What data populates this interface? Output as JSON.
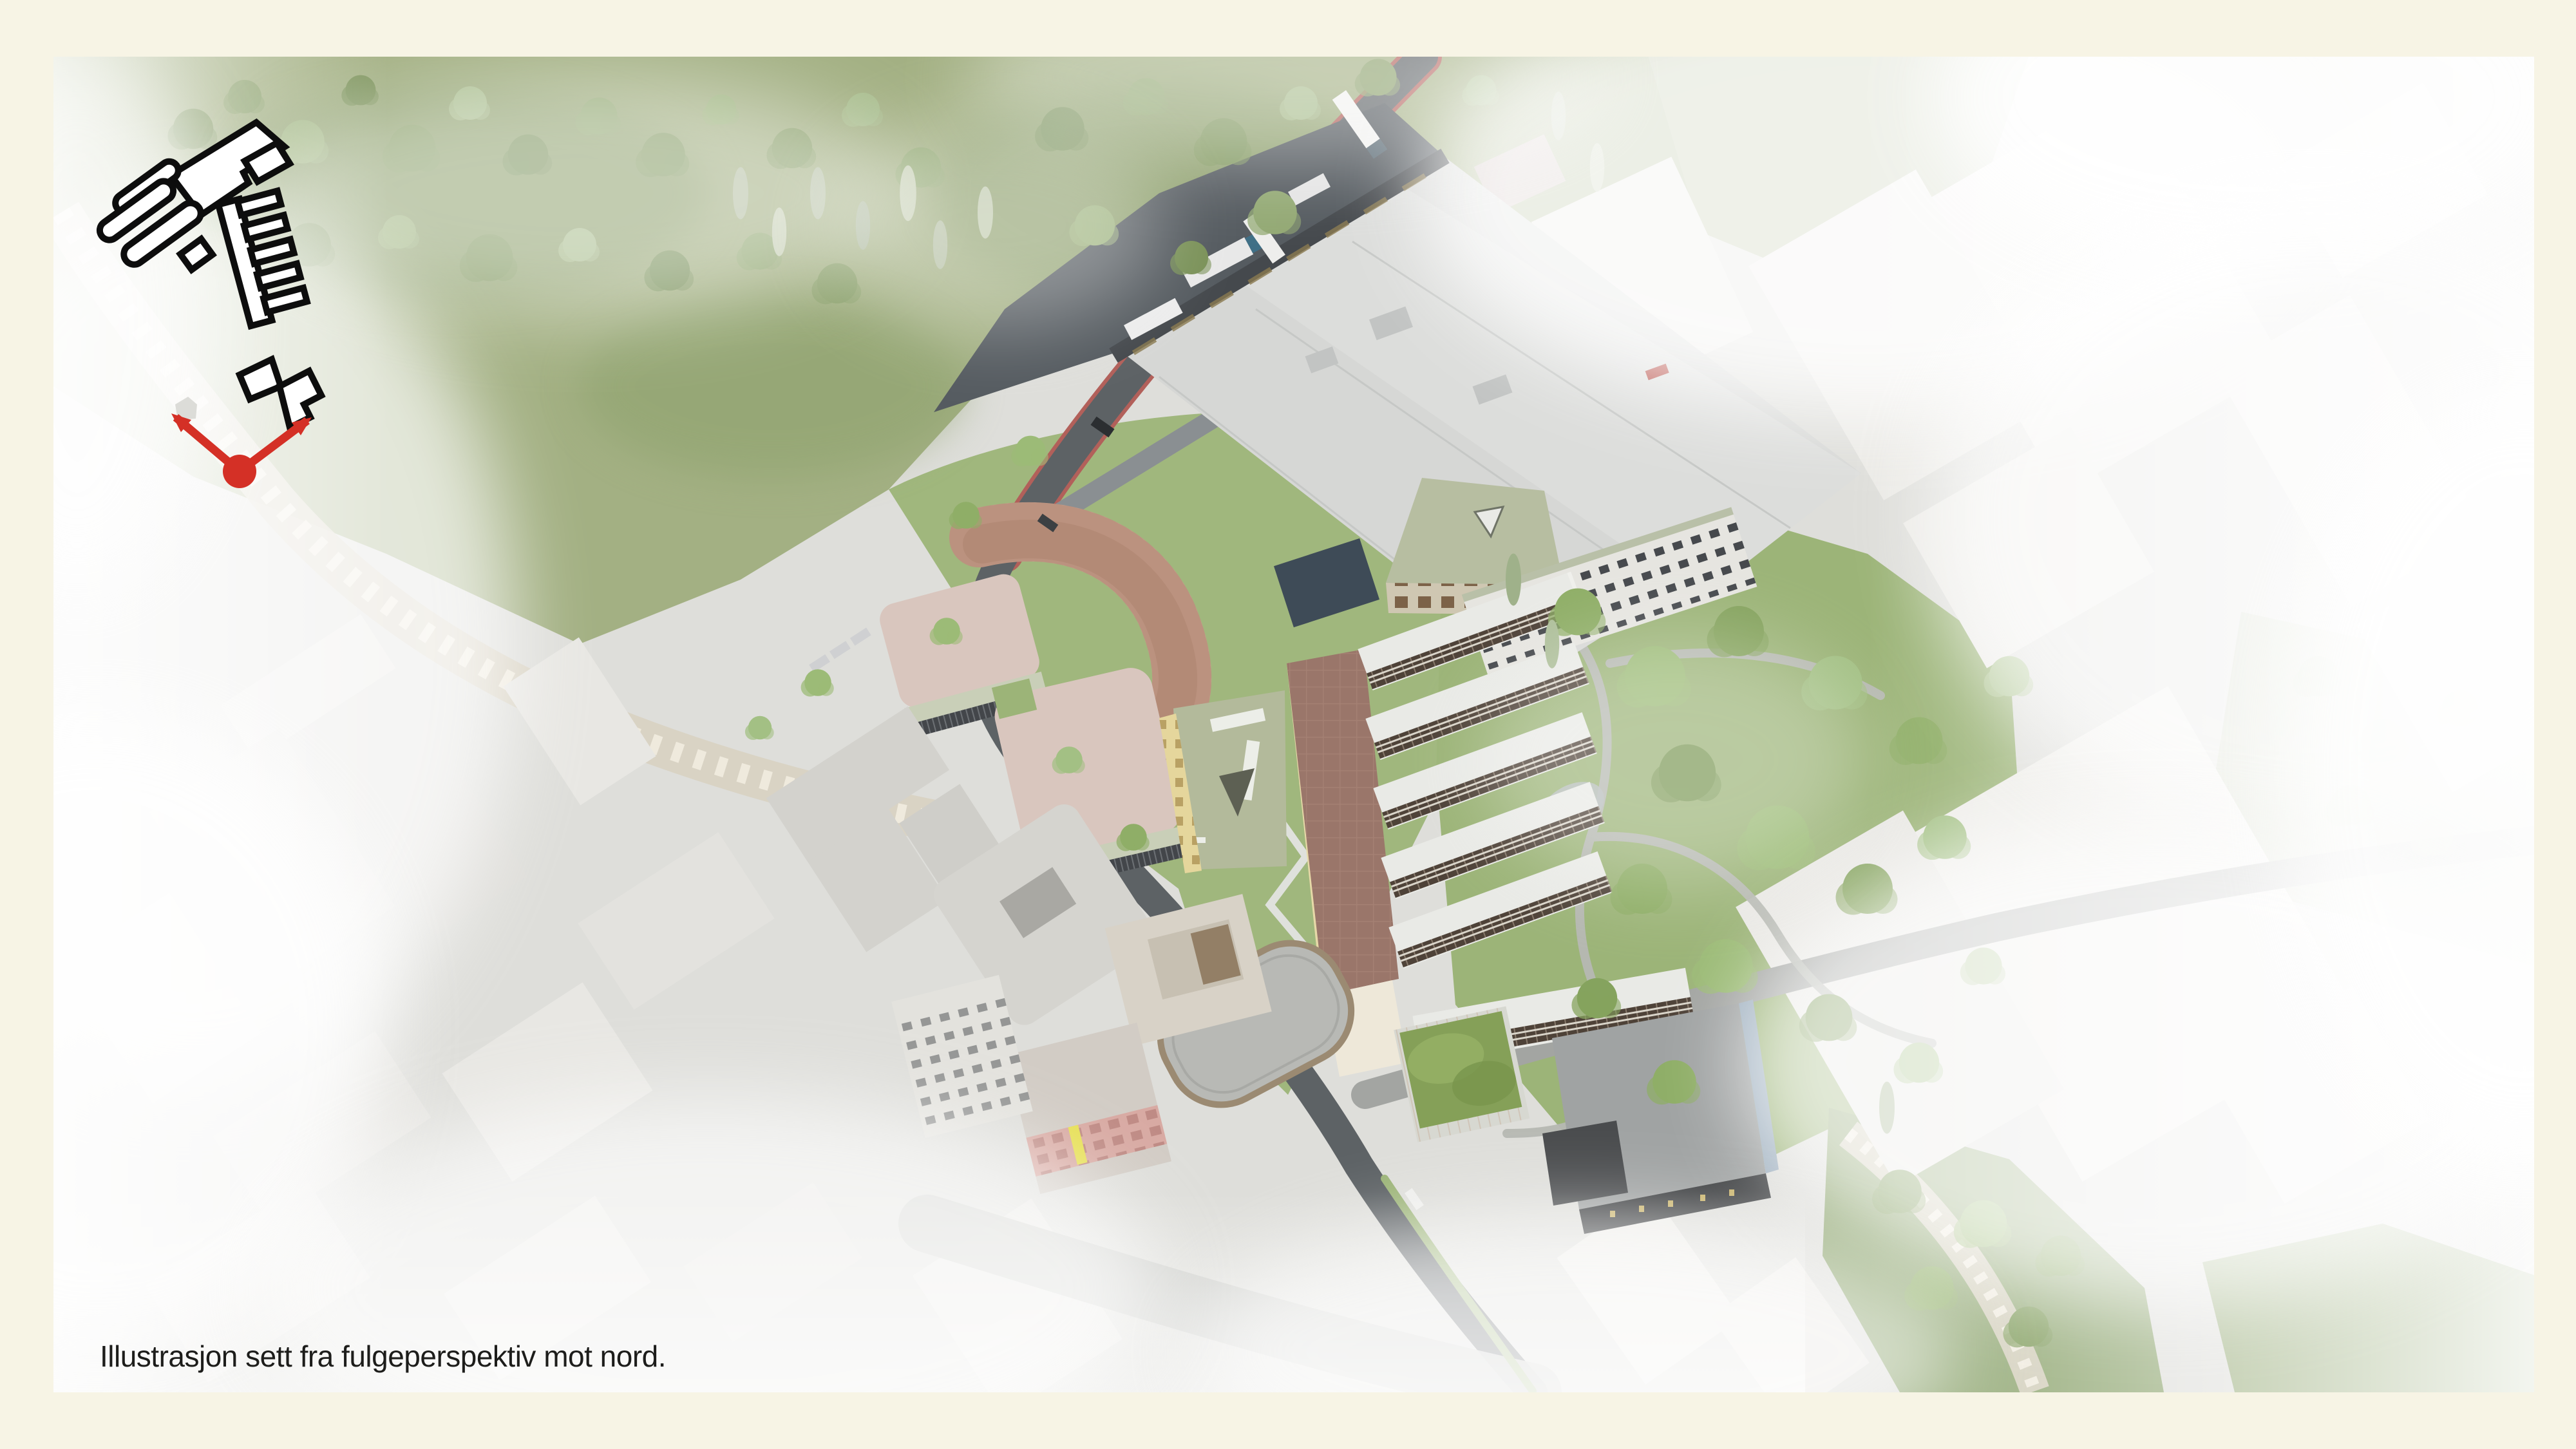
{
  "caption": {
    "text": "Illustrasjon sett fra fulgeperspektiv mot nord."
  },
  "locator": {
    "icons": [
      {
        "name": "site-footprint-outlines",
        "style": "white building footprints with black outline"
      },
      {
        "name": "view-direction-arrow",
        "style": "red V-shaped arrow with dot at viewpoint"
      }
    ]
  },
  "palette": {
    "frame_background": "#f7f4e5",
    "city_base": "#dededa",
    "fog_white": "#ffffff",
    "forest_green": "#a3b083",
    "park_green": "#9cb478",
    "road_asphalt": "#5d6265",
    "bike_lane_red": "#b2605a",
    "path_gray": "#b7b9b3",
    "cliff_rock": "#d8d1c1",
    "warehouse_roof": "#d6d7d5",
    "warehouse_wall": "#45494d",
    "terracotta_building": "#c49b88",
    "pink_roof": "#d9c6be",
    "sage_facade": "#c9cfb8",
    "sage_roof": "#b3ba9b",
    "yellow_facade": "#e5d69c",
    "comb_spine_roof": "#9a766a",
    "wing_roof": "#e9eae6",
    "wing_facade": "#4e4238",
    "green_roof": "#85a058",
    "charcoal_building": "#3c3e40",
    "oval_hall_roof": "#b8b9b5",
    "locator_outline": "#0d0d0d",
    "locator_fill": "#ffffff",
    "view_arrow_red": "#d43026",
    "caption_color": "#1d1d1b"
  }
}
